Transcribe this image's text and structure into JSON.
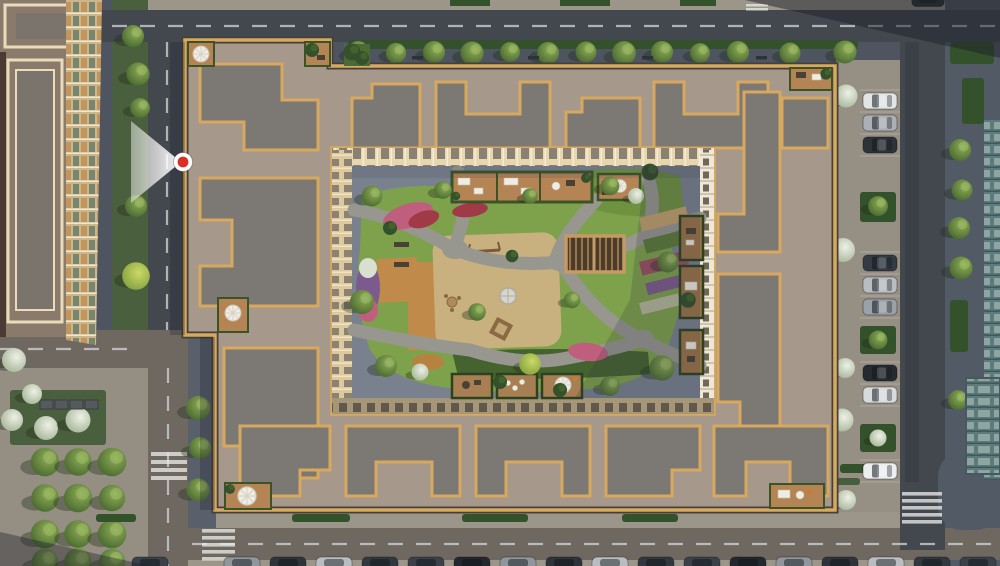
{
  "meta": {
    "kind": "aerial-masterplan-render",
    "width": 1000,
    "height": 566
  },
  "marker": {
    "name": "camera-view-marker",
    "direction": "west",
    "dot_color": "#d93025",
    "ring_color": "#ffffff",
    "cone_color": "#ffffff"
  },
  "palette": {
    "base": "#9b958a",
    "paverDark": "#4e5560",
    "paverMid": "#59606b",
    "plaza": "#948e83",
    "roadDark": "#43474e",
    "roadLight": "#6e6861",
    "roadLine": "#ccced0",
    "grassStrip": "#4a5f3d",
    "hedge": "#33512a",
    "lawn": "#7ea14c",
    "lawnDark": "#45632f",
    "sand": "#c9b17f",
    "path": "#97978f",
    "gravel": "#79818e",
    "roofTan": "#a6988a",
    "roofGray": "#7c7873",
    "trimGold": "#d7a95f",
    "trimEdge": "#45413a",
    "facadeCream": "#e7d6ae",
    "facadeWhite": "#efe8d8",
    "facadeShade": "#a59678",
    "facadeSide": "#dcc9a0",
    "deck": "#b58455",
    "wood": "#c08a4b",
    "pergolaWood": "#9a7448",
    "pergolaDark": "#4a3c2a",
    "flowerPink": "#c05f7d",
    "flowerRed": "#a03a47",
    "flowerPurple": "#7d5a8d",
    "flowerWhite": "#dadfd0",
    "blossom": "#ccd4c2",
    "brightLeaf": "#b7c857",
    "shadow": "#1d212a",
    "markerRed": "#d93025",
    "neighborRoof": "#8a7a6b",
    "neighborTrimCream": "#e9dcbb",
    "glassTeal": "#5d7a7c",
    "glassBlue": "#5a7482"
  },
  "vehicles": {
    "rightParking": [
      "#e2e4e6",
      "#aab0b6",
      "#2e3339",
      "#343b44",
      "#b9bdc2",
      "#9aa1a8",
      "#262b31",
      "#d8dbdd",
      "#eceeef"
    ],
    "bottomRow": [
      "#3a4149",
      "#23282e",
      "#8f969c",
      "#2e3439",
      "#b9bdc2",
      "#31383f"
    ],
    "topEdge": [
      "#2b3137"
    ]
  },
  "scene_labels": {
    "courtyard": "courtyard-garden",
    "playground": "playground",
    "pergola": "pergola",
    "terraces": "rooftop-terraces",
    "parking_right": "street-parking-right",
    "parking_bottom": "street-parking-bottom",
    "plaza": "tree-plaza"
  }
}
